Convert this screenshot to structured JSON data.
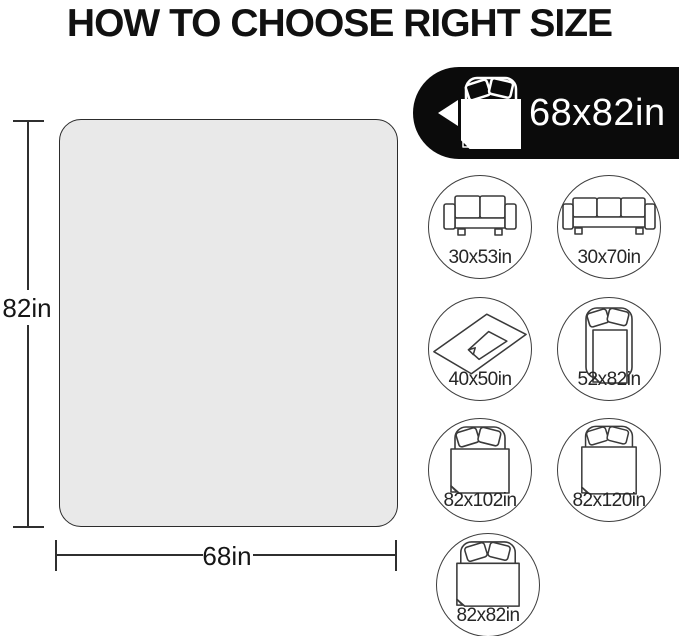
{
  "title": "HOW TO CHOOSE RIGHT SIZE",
  "diagram": {
    "height_label": "82in",
    "width_label": "68in"
  },
  "banner": {
    "size_label": "68x82in",
    "icon": "bed-with-blanket-icon",
    "arrow": "left-arrow-icon"
  },
  "options": [
    {
      "size": "30x53in",
      "icon": "loveseat-sofa-icon"
    },
    {
      "size": "30x70in",
      "icon": "three-seat-sofa-icon"
    },
    {
      "size": "40x50in",
      "icon": "flat-throw-blanket-icon"
    },
    {
      "size": "52x82in",
      "icon": "twin-bed-blanket-icon"
    },
    {
      "size": "82x102in",
      "icon": "full-bed-blanket-icon"
    },
    {
      "size": "82x120in",
      "icon": "king-bed-blanket-icon"
    },
    {
      "size": "82x82in",
      "icon": "square-bed-blanket-icon"
    }
  ],
  "colors": {
    "banner_bg": "#0b0b0b",
    "blanket_fill": "#e9e9e9",
    "outline": "#3a3a3a",
    "text": "#111111"
  }
}
